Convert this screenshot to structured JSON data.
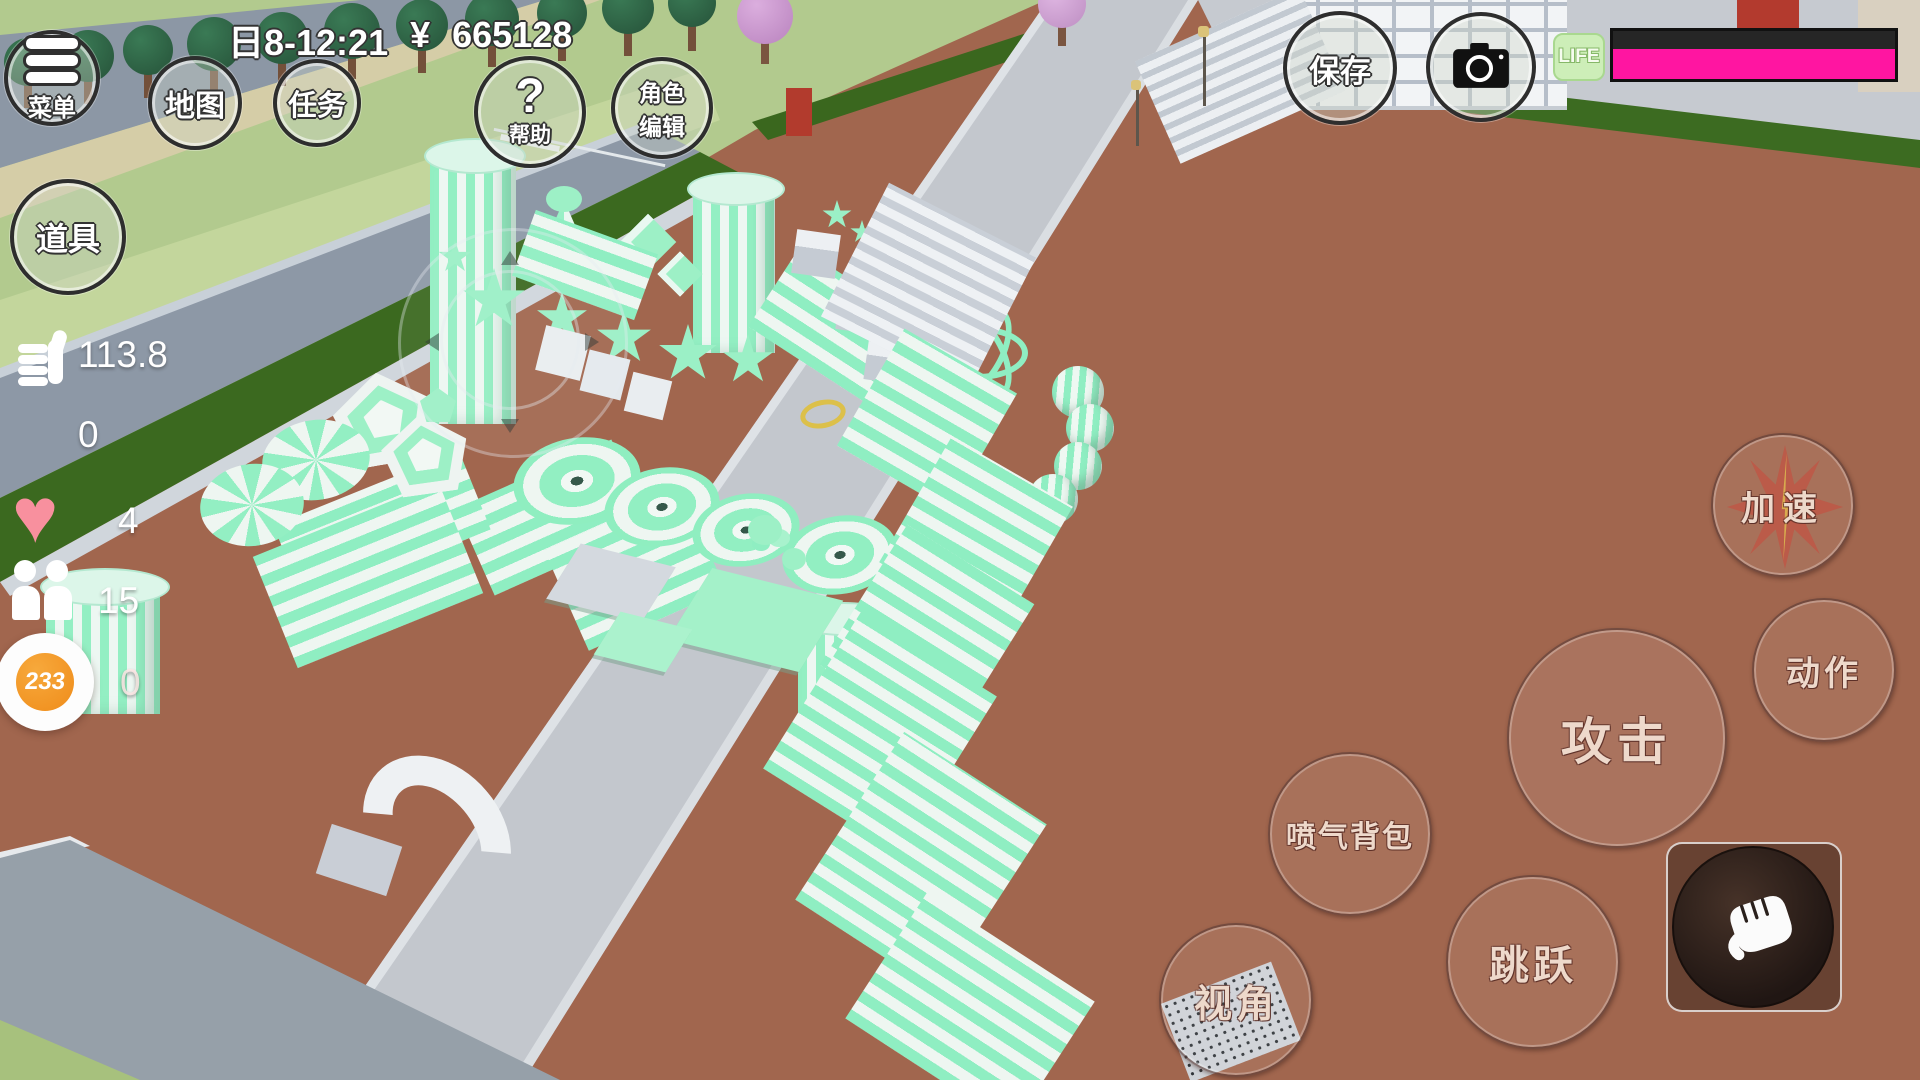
{
  "status_bar": {
    "time": "日8-12:21",
    "currency": "¥",
    "amount": "665128"
  },
  "buttons": {
    "menu": "菜单",
    "map": "地图",
    "task": "任务",
    "help": "帮助",
    "help_mark": "?",
    "char_edit_l1": "角色",
    "char_edit_l2": "编辑",
    "props": "道具",
    "save": "保存",
    "boost": "加速",
    "action": "动作",
    "attack": "攻击",
    "jetpack": "喷气背包",
    "jump": "跳跃",
    "view": "视角"
  },
  "life": {
    "label": "LIFE",
    "percent": 100
  },
  "stats": {
    "likes": "113.8",
    "counter_a": "0",
    "hearts": "4",
    "people": "15",
    "badge": "233",
    "counter_b": "0"
  },
  "colors": {
    "life_pink": "#ff15a1",
    "mint": "#8feec2",
    "brick": "#a1664e",
    "badge_orange": "#f08c1e"
  }
}
